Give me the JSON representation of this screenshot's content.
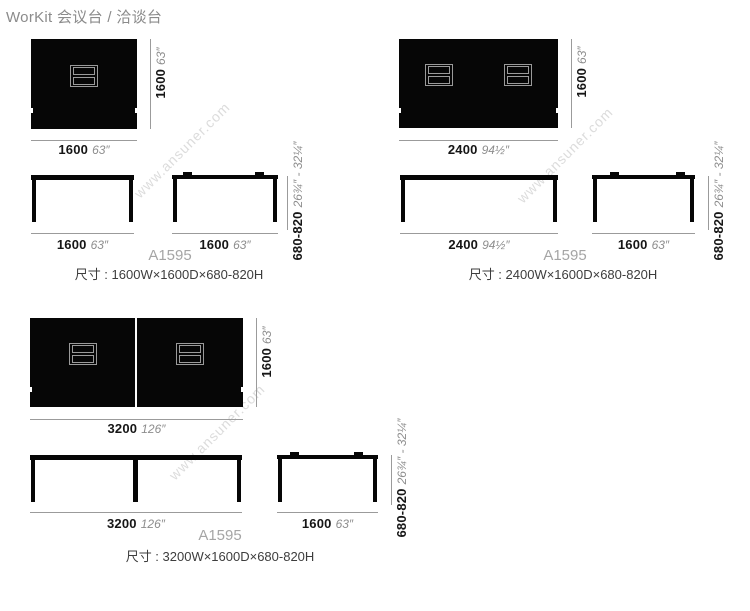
{
  "title": "WorKit 会议台 / 洽谈台",
  "watermark": "www.ansuner.com",
  "colors": {
    "tabletop": "#060606",
    "dimension_line": "#9b9b9b",
    "mm_text": "#161616",
    "inch_text": "#8d8d8d",
    "model_text": "#a5a5a5",
    "caption_text": "#3d3d3d",
    "watermark_text": "#dcdcdc"
  },
  "groups": [
    {
      "model": "A1595",
      "caption": "尺寸 : 1600W×1600D×680-820H",
      "top": {
        "width_mm": "1600",
        "width_in": "63″",
        "depth_mm": "1600",
        "depth_in": "63″"
      },
      "front": {
        "width_mm": "1600",
        "width_in": "63″"
      },
      "side": {
        "width_mm": "1600",
        "width_in": "63″"
      },
      "height": {
        "mm": "680-820",
        "in": "26¾″ - 32¼″"
      }
    },
    {
      "model": "A1595",
      "caption": "尺寸 : 2400W×1600D×680-820H",
      "top": {
        "width_mm": "2400",
        "width_in": "94½″",
        "depth_mm": "1600",
        "depth_in": "63″"
      },
      "front": {
        "width_mm": "2400",
        "width_in": "94½″"
      },
      "side": {
        "width_mm": "1600",
        "width_in": "63″"
      },
      "height": {
        "mm": "680-820",
        "in": "26¾″ - 32¼″"
      }
    },
    {
      "model": "A1595",
      "caption": "尺寸 : 3200W×1600D×680-820H",
      "top": {
        "width_mm": "3200",
        "width_in": "126″",
        "depth_mm": "1600",
        "depth_in": "63″"
      },
      "front": {
        "width_mm": "3200",
        "width_in": "126″"
      },
      "side": {
        "width_mm": "1600",
        "width_in": "63″"
      },
      "height": {
        "mm": "680-820",
        "in": "26¾″ - 32¼″"
      }
    }
  ]
}
